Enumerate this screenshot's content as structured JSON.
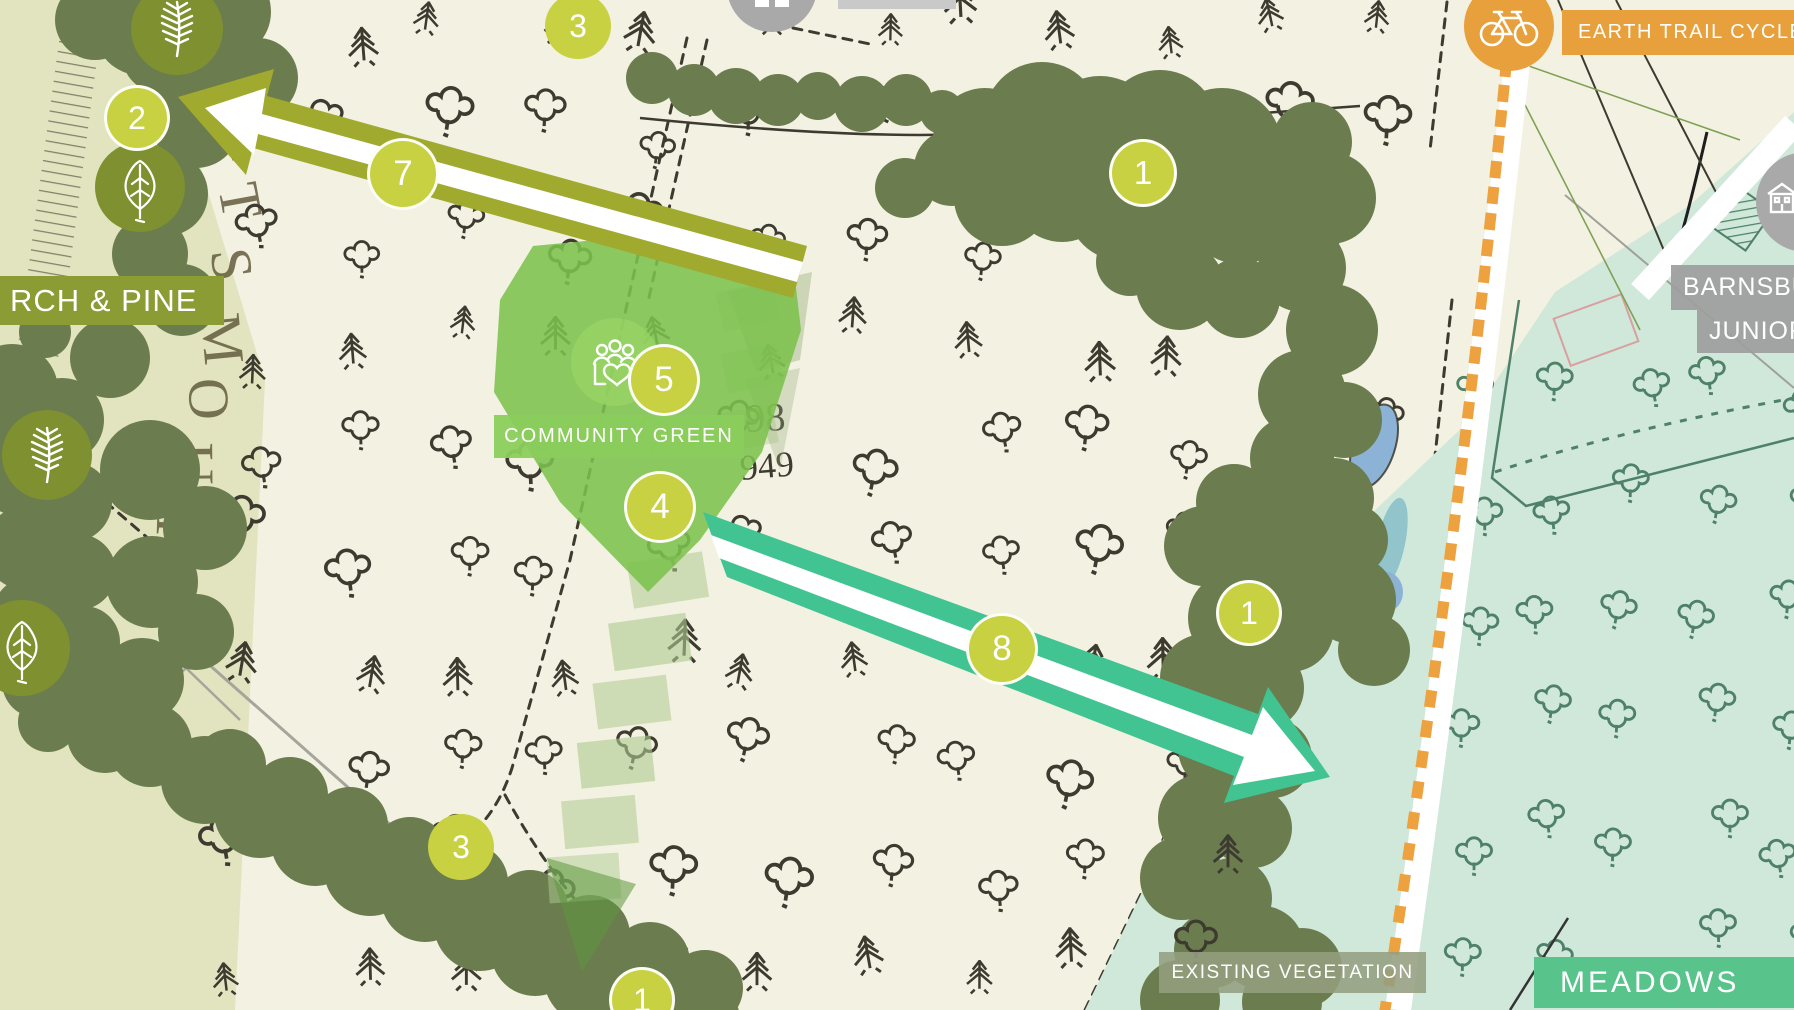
{
  "colors": {
    "map_cream": "#f3f1e2",
    "pale_verge": "#e1e4bf",
    "ink": "#3d3b30",
    "canopy_green": "#6b7c4e",
    "icon_circle_olive": "#7f9030",
    "marker_yellow_green": "#c7d142",
    "olive_arrow": "#a0aa2e",
    "teal_arrow": "#41c492",
    "mint_area": "#cfe8da",
    "mint_ink": "#4e8168",
    "community_green": "#7cc24d",
    "community_label_green": "#8bce5c",
    "stepping_stone": "#aecb8f",
    "orange_accent": "#e8a03c",
    "orange_dash": "#eda23f",
    "meadows_green": "#58c38b",
    "veg_label_gray": "rgba(148,158,128,0.88)",
    "school_label_gray": "rgba(157,157,157,0.92)",
    "pond_blue": "#8cb2d6",
    "pond_teal": "#92c4cc"
  },
  "map_labels": [
    {
      "id": "birch-pine",
      "text": "RCH & PINE",
      "x": 0,
      "y": 276,
      "w": 214,
      "h": 49,
      "bg": "#8a9c33",
      "fs": 31,
      "ls": 1,
      "pl": 10,
      "align": "left"
    },
    {
      "id": "community-green",
      "text": "COMMUNITY GREEN",
      "x": 494,
      "y": 415,
      "w": 250,
      "h": 43,
      "bg": "rgba(139,206,92,0.95)",
      "fs": 20,
      "ls": 2,
      "pl": 0,
      "align": "center"
    },
    {
      "id": "earth-trail-cycle",
      "text": "EARTH TRAIL CYCLE",
      "x": 1562,
      "y": 10,
      "w": 240,
      "h": 45,
      "bg": "#e8a03c",
      "fs": 20,
      "ls": 1.5,
      "pl": 16,
      "align": "left"
    },
    {
      "id": "barnsbury",
      "text": "BARNSBURY",
      "x": 1671,
      "y": 265,
      "w": 200,
      "h": 45,
      "bg": "rgba(157,157,157,0.92)",
      "fs": 25,
      "ls": 1,
      "pl": 12,
      "align": "left"
    },
    {
      "id": "junior",
      "text": "JUNIOR",
      "x": 1697,
      "y": 310,
      "w": 160,
      "h": 43,
      "bg": "rgba(157,157,157,0.92)",
      "fs": 25,
      "ls": 1,
      "pl": 12,
      "align": "left"
    },
    {
      "id": "meadows",
      "text": "MEADOWS",
      "x": 1534,
      "y": 957,
      "w": 266,
      "h": 51,
      "bg": "#58c38b",
      "fs": 30,
      "ls": 3,
      "pl": 26,
      "align": "left"
    },
    {
      "id": "existing-vegetation",
      "text": "EXISTING VEGETATION",
      "x": 1159,
      "y": 952,
      "w": 267,
      "h": 41,
      "bg": "rgba(148,158,128,0.88)",
      "fs": 19,
      "ls": 1.5,
      "pl": 0,
      "align": "center"
    }
  ],
  "markers": [
    {
      "n": "2",
      "x": 137,
      "y": 118,
      "r": 33,
      "ring": true
    },
    {
      "n": "3",
      "x": 578,
      "y": 26,
      "r": 33,
      "ring": false
    },
    {
      "n": "7",
      "x": 403,
      "y": 174,
      "r": 36,
      "ring": true
    },
    {
      "n": "1",
      "x": 1143,
      "y": 173,
      "r": 34,
      "ring": true
    },
    {
      "n": "5",
      "x": 664,
      "y": 380,
      "r": 36,
      "ring": true
    },
    {
      "n": "4",
      "x": 660,
      "y": 507,
      "r": 36,
      "ring": true
    },
    {
      "n": "8",
      "x": 1002,
      "y": 649,
      "r": 36,
      "ring": true
    },
    {
      "n": "1",
      "x": 1249,
      "y": 613,
      "r": 33,
      "ring": true
    },
    {
      "n": "3",
      "x": 461,
      "y": 847,
      "r": 33,
      "ring": false
    },
    {
      "n": "1",
      "x": 642,
      "y": 1000,
      "r": 33,
      "ring": true
    }
  ],
  "icon_circles": [
    {
      "icon": "pine-branch",
      "x": 177,
      "y": 29,
      "r": 46,
      "bg": "#7f9030"
    },
    {
      "icon": "birch-leaf",
      "x": 140,
      "y": 187,
      "r": 45,
      "bg": "#7f9030"
    },
    {
      "icon": "pine-branch",
      "x": 47,
      "y": 455,
      "r": 45,
      "bg": "#7f9030"
    },
    {
      "icon": "birch-leaf",
      "x": 22,
      "y": 648,
      "r": 48,
      "bg": "#7f9030"
    },
    {
      "icon": "people-heart",
      "x": 615,
      "y": 362,
      "r": 44,
      "bg": "rgba(151,211,100,0.8)"
    },
    {
      "icon": "bicycle",
      "x": 1509,
      "y": 26,
      "r": 45,
      "bg": "#e8a03c"
    },
    {
      "icon": "school-building",
      "x": 1806,
      "y": 202,
      "r": 50,
      "bg": "#a9a9a9"
    },
    {
      "icon": "viewpoint",
      "x": 772,
      "y": -13,
      "r": 45,
      "bg": "#a9a9a9"
    }
  ],
  "map_numbers": [
    {
      "text": "98",
      "x": 746,
      "y": 432,
      "fs": 40,
      "rot": -3,
      "color": "#3d3b30",
      "serif": true
    },
    {
      "text": "949",
      "x": 741,
      "y": 480,
      "fs": 36,
      "rot": -5,
      "color": "#3d3b30",
      "serif": true
    },
    {
      "text": "78",
      "x": 1750,
      "y": 352,
      "fs": 26,
      "rot": -15,
      "color": "#4e8168",
      "serif": true
    },
    {
      "text": "3",
      "x": 1646,
      "y": 448,
      "fs": 22,
      "rot": -10,
      "color": "#4e8168",
      "serif": true
    }
  ],
  "road_name": "PORTSMOUTH",
  "misc": {
    "gray_bar": {
      "x": 838,
      "y": 0,
      "w": 118,
      "h": 9,
      "bg": "#c9c9c9"
    }
  }
}
